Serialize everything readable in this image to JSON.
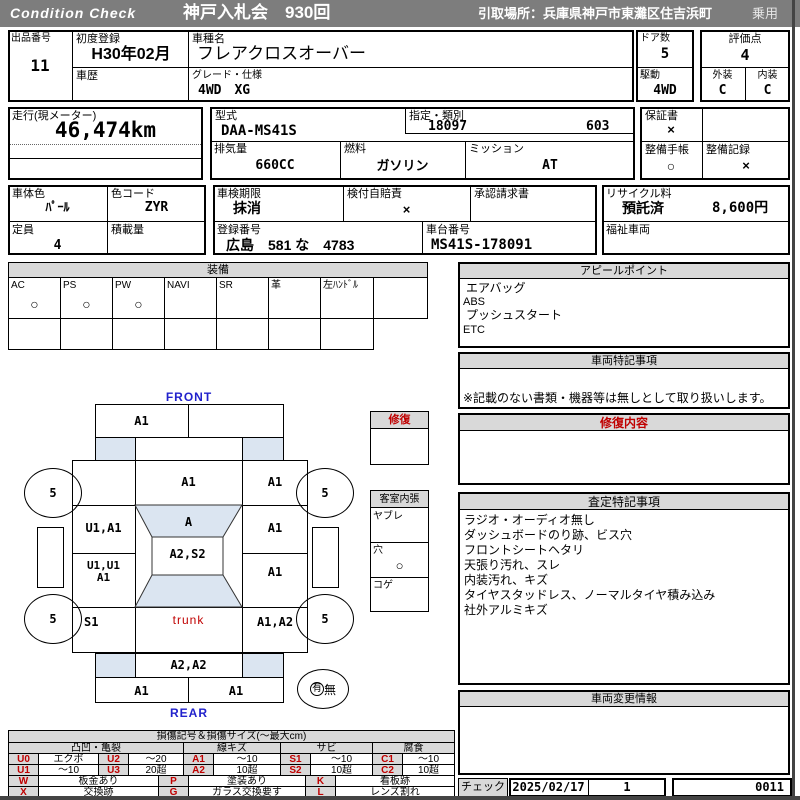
{
  "header": {
    "brand": "Condition  Check",
    "auction": "神戸入札会　930回",
    "pickup": "引取場所：兵庫県神戸市東灘区住吉浜町",
    "category": "乗用"
  },
  "info": {
    "lot_label": "出品番号",
    "lot": "11",
    "first_reg_label": "初度登録",
    "first_reg": "H30年02月",
    "history_label": "車歴",
    "history": "",
    "model_label": "車種名",
    "model": "フレアクロスオーバー",
    "grade_label": "グレード・仕様",
    "grade": "4WD　XG",
    "doors_label": "ドア数",
    "doors": "5",
    "score_label": "評価点",
    "score": "4",
    "drive_label": "駆動",
    "drive": "4WD",
    "ext_label": "外装",
    "ext": "C",
    "int_label": "内装",
    "int": "C",
    "mileage_label": "走行(現メーター)",
    "mileage": "46,474km",
    "model_code_label": "型式",
    "model_code": "DAA-MS41S",
    "class_label": "指定・類別",
    "class1": "18097",
    "class2": "603",
    "warranty_label": "保証書",
    "warranty": "×",
    "disp_label": "排気量",
    "disp": "660CC",
    "fuel_label": "燃料",
    "fuel": "ガソリン",
    "mission_label": "ミッション",
    "mission": "AT",
    "book_label": "整備手帳",
    "book": "○",
    "record_label": "整備記録",
    "record": "×",
    "color_label": "車体色",
    "color": "ﾊﾟｰﾙ",
    "ccode_label": "色コード",
    "ccode": "ZYR",
    "shaken_label": "車検期限",
    "shaken": "抹消",
    "jibai_label": "検付自賠責",
    "jibai": "×",
    "approval_label": "承認請求書",
    "approval": "",
    "recycle_label": "リサイクル料",
    "recycle_status": "預託済",
    "recycle_fee": "8,600円",
    "capacity_label": "定員",
    "capacity": "4",
    "load_label": "積載量",
    "load": "",
    "regno_label": "登録番号",
    "regno": "広島　581 な　4783",
    "chassis_label": "車台番号",
    "chassis": "MS41S-178091",
    "welfare_label": "福祉車両",
    "welfare": ""
  },
  "equipment": {
    "title": "装備",
    "items": [
      {
        "label": "AC",
        "value": "○"
      },
      {
        "label": "PS",
        "value": "○"
      },
      {
        "label": "PW",
        "value": "○"
      },
      {
        "label": "NAVI",
        "value": ""
      },
      {
        "label": "SR",
        "value": ""
      },
      {
        "label": "革",
        "value": ""
      },
      {
        "label": "左ﾊﾝﾄﾞﾙ",
        "value": ""
      }
    ]
  },
  "appeal": {
    "title": "アピールポイント",
    "lines": [
      "エアバッグ",
      "ABS",
      "プッシュスタート",
      "ETC"
    ]
  },
  "notes": {
    "title": "車両特記事項",
    "note": "※記載のない書類・機器等は無しとして取り扱いします。"
  },
  "repair_detail": {
    "title": "修復内容"
  },
  "assessment": {
    "title": "査定特記事項",
    "lines": [
      "ラジオ・オーディオ無し",
      "ダッシュボードのり跡、ビス穴",
      "フロントシートヘタリ",
      "天張り汚れ、スレ",
      "内装汚れ、キズ",
      "タイヤスタッドレス、ノーマルタイヤ積み込み",
      "社外アルミキズ"
    ]
  },
  "change_info": {
    "title": "車両変更情報"
  },
  "footer": {
    "check_label": "チェック",
    "date": "2025/02/17",
    "count": "1",
    "serial": "0011"
  },
  "diagram": {
    "front": "FRONT",
    "rear": "REAR",
    "panels": {
      "front_bumper_left": "A1",
      "front_bumper_right": "",
      "hood": "A1",
      "right_row1": "A1",
      "left_row1": "",
      "windshield": "A",
      "left_row2": "U1,A1",
      "right_row2": "A1",
      "roof": "A2,S2",
      "left_row3": "U1,U1\nA1",
      "right_row3": "A1",
      "left_row4": "S1",
      "trunk": "trunk",
      "right_row4": "A1,A2",
      "rear_panel": "A2,A2",
      "rear_bumper_left": "A1",
      "rear_bumper_right": "A1"
    },
    "tires": {
      "fl": "5",
      "fr": "5",
      "rl": "5",
      "rr": "5"
    },
    "repair_box": {
      "title": "修復"
    },
    "cabin_box": {
      "title": "客室内張",
      "items": [
        {
          "label": "ヤブレ",
          "value": ""
        },
        {
          "label": "穴",
          "value": "○"
        },
        {
          "label": "コゲ",
          "value": ""
        }
      ]
    },
    "presence": {
      "yes": "有",
      "no": "無"
    }
  },
  "legend": {
    "title": "損傷記号＆損傷サイズ(〜最大cm)",
    "groups": [
      "凸凹・亀裂",
      "線キズ",
      "サビ",
      "腐食"
    ],
    "row1": [
      {
        "code": "U0",
        "desc": "エクボ"
      },
      {
        "code": "U2",
        "desc": "〜20"
      },
      {
        "code": "A1",
        "desc": "〜10"
      },
      {
        "code": "S1",
        "desc": "〜10"
      },
      {
        "code": "C1",
        "desc": "〜10"
      }
    ],
    "row2": [
      {
        "code": "U1",
        "desc": "〜10"
      },
      {
        "code": "U3",
        "desc": "20超"
      },
      {
        "code": "A2",
        "desc": "10超"
      },
      {
        "code": "S2",
        "desc": "10超"
      },
      {
        "code": "C2",
        "desc": "10超"
      }
    ],
    "marks_row1": [
      {
        "code": "W",
        "desc": "板金あり"
      },
      {
        "code": "P",
        "desc": "塗装あり"
      },
      {
        "code": "K",
        "desc": "看板跡"
      }
    ],
    "marks_row2": [
      {
        "code": "X",
        "desc": "交換跡"
      },
      {
        "code": "G",
        "desc": "ガラス交換要す"
      },
      {
        "code": "L",
        "desc": "レンズ割れ"
      }
    ]
  },
  "colors": {
    "bar_gray": "#7d7d7d",
    "header_gray": "#d9d9d9",
    "glass_blue": "#dbe5f1",
    "accent_red": "#c00000",
    "accent_blue": "#2222cc"
  }
}
